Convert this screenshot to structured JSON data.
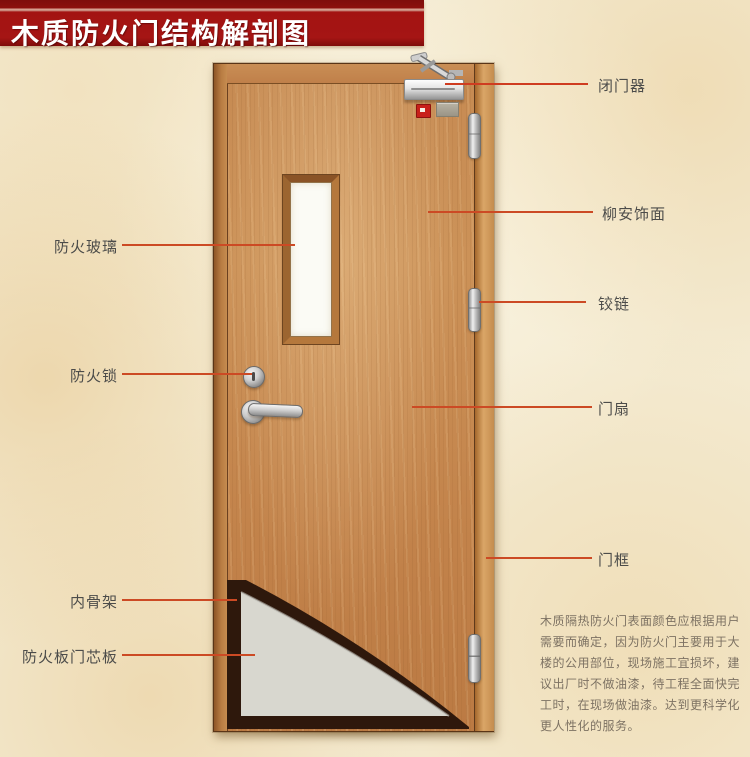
{
  "title": {
    "text": "木质防火门结构解剖图"
  },
  "labels": {
    "left": [
      {
        "text": "防火玻璃"
      },
      {
        "text": "防火锁"
      },
      {
        "text": "内骨架"
      },
      {
        "text": "防火板门芯板"
      }
    ],
    "right": [
      {
        "text": "闭门器"
      },
      {
        "text": "柳安饰面"
      },
      {
        "text": "铰链"
      },
      {
        "text": "门扇"
      },
      {
        "text": "门框"
      }
    ]
  },
  "note": {
    "lines": [
      "木质隔热防火门表面颜色应根据用户",
      "需要而确定，因为防火门主要用于大",
      "楼的公用部位，现场施工宜损坏，建",
      "议出厂时不做油漆，待工程全面快完",
      "工时，在现场做油漆。达到更科学化",
      "更人性化的服务。"
    ]
  },
  "colors": {
    "banner_red": "#a31312",
    "leader_line": "#cc4a24",
    "label_text": "#4c4c4a",
    "wood": "#c68a52",
    "glass_white": "#fbfbf5",
    "skeleton_dark": "#2e180c",
    "core_panel_gray": "#d8d7cf",
    "background_parchment": "#f4ebd2"
  }
}
